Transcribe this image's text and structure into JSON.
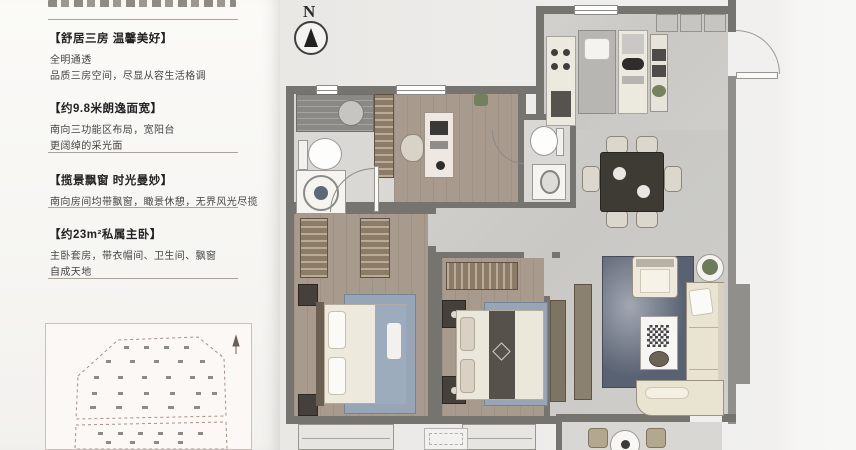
{
  "palette": {
    "wall": "#75746f",
    "wood_floor": "#a89b8e",
    "marble_floor": "#cbcac6",
    "bath_tile": "#d9d8d4",
    "rug_blue": "#97a6b6",
    "living_rug": "#596273",
    "wardrobe_brown": "#8b7b67",
    "sofa_cream": "#e9e3d2",
    "background_left": "#f8f7f4",
    "background_right": "#f7f7f5"
  },
  "sidebar": {
    "sections": [
      {
        "heading": "【舒居三房 温馨美好】",
        "line1": "全明通透",
        "line2": "品质三房空间，尽显从容生活格调"
      },
      {
        "heading": "【约9.8米朗逸面宽】",
        "line1": "南向三功能区布局，宽阳台",
        "line2": "更阔绰的采光面"
      },
      {
        "heading": "【揽景飘窗 时光曼妙】",
        "line1": "南向房间均带飘窗，瞰景休憩，无界风光尽揽",
        "line2": ""
      },
      {
        "heading": "【约23m²私属主卧】",
        "line1": "主卧套房，带衣帽间、卫生间、飘窗",
        "line2": "自成天地"
      }
    ]
  },
  "floorplan": {
    "north_label": "N"
  }
}
